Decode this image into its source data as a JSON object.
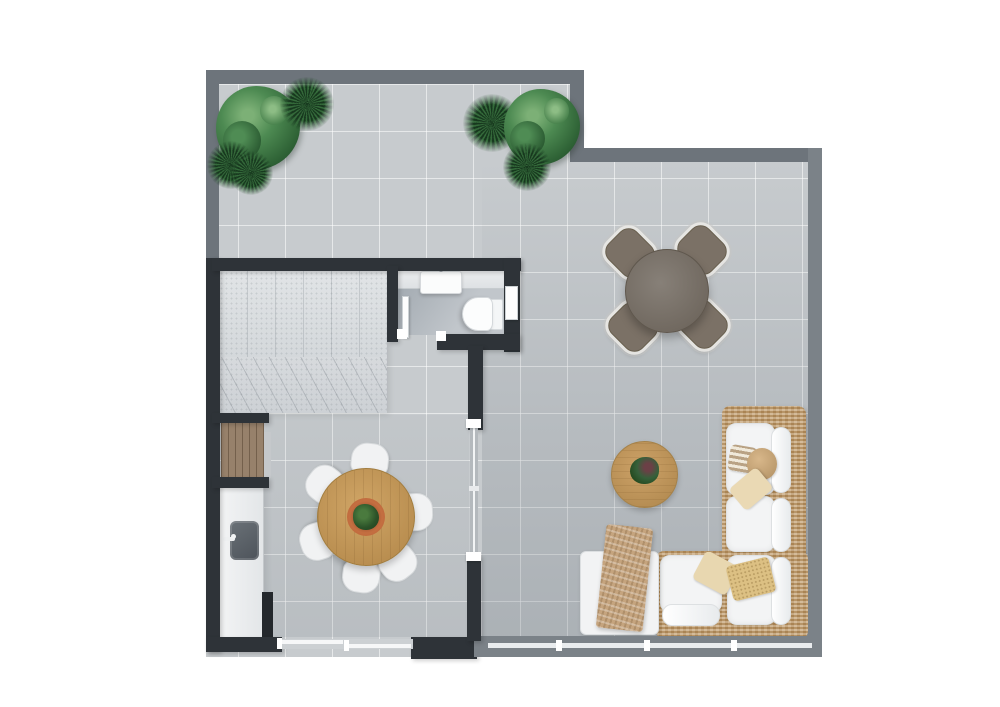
{
  "scene": {
    "type": "3d-floor-plan-top-view",
    "background": "#ffffff",
    "text_visible": "none"
  },
  "palette": {
    "wall_dark": "#2e3338",
    "wall_gray": "#6d747b",
    "wall_gray2": "#7b8288",
    "floor": "#c7cbce",
    "floor_grout": "#d9dcde",
    "stairs_stone": "#dadde0",
    "wood_table": "#c2985c",
    "wood_cabinet": "#97816b",
    "rattan": "#c19c6b",
    "cushion_white": "#f3f4f5",
    "pillow_beige": "#e8d7b0",
    "pillow_gold": "#dcc083",
    "throw_tan": "#c5a47e",
    "outdoor_set_gray": "#7b7166",
    "terracotta_bowl": "#c46f41",
    "plant_green": "#3c7a43",
    "sink_dark": "#565c62"
  },
  "areas": [
    {
      "name": "roof-terrace",
      "floor": "light gray tiles",
      "position": "top, wrapping right side"
    },
    {
      "name": "staircase-room",
      "floor": "speckled stone with winder steps",
      "position": "middle-left"
    },
    {
      "name": "bathroom",
      "fixtures": "vanity with sink, wall-hung toilet, two doors",
      "position": "center, right of staircase"
    },
    {
      "name": "kitchen-dining-room",
      "features": "wall counter with sink, wood cabinet niche, round table for six",
      "position": "lower-left"
    },
    {
      "name": "living-lounge-area",
      "features": "outdoor dining set, L-shaped rattan sofa, coffee table",
      "position": "right"
    }
  ],
  "furniture": [
    {
      "name": "outdoor-dining-set",
      "description": "round gray table with four rotated square rattan-edged chairs",
      "location": "upper right area"
    },
    {
      "name": "indoor-dining-set",
      "description": "round wooden table with terracotta planter centerpiece and six white chairs",
      "location": "lower-left room"
    },
    {
      "name": "sectional-sofa",
      "description": "L-shaped rattan-frame sofa with white cushions, beige and gold pillows, tan throw, white chaise",
      "location": "bottom right corner"
    },
    {
      "name": "coffee-table",
      "description": "round wooden table with small plant",
      "location": "left of sofa"
    },
    {
      "name": "sideboard-cabinet",
      "description": "wood plank cabinet in wall niche",
      "location": "left wall niche"
    },
    {
      "name": "kitchen-counter",
      "description": "white counter with dark undermount sink and faucet",
      "location": "along left wall"
    },
    {
      "name": "kitchen-appliance",
      "description": "slim dark unit at counter end",
      "location": "bottom of counter"
    }
  ],
  "fixtures": [
    {
      "name": "glass-slider-interior",
      "location": "between dining room and lounge"
    },
    {
      "name": "sliding-door-bottom-left",
      "location": "bottom wall of dining room"
    },
    {
      "name": "sliding-door-bottom-right",
      "location": "bottom wall of lounge"
    },
    {
      "name": "bathroom-door-west",
      "location": "bathroom lower-left corner"
    },
    {
      "name": "bathroom-door-east",
      "location": "bathroom right wall"
    }
  ],
  "plants": [
    {
      "name": "fiddle-leaf-plant",
      "count": 2,
      "location": "terrace top-left and top-center"
    },
    {
      "name": "spiky-palm-plant",
      "count": 5,
      "location": "terrace top-left and top-center clusters"
    }
  ]
}
